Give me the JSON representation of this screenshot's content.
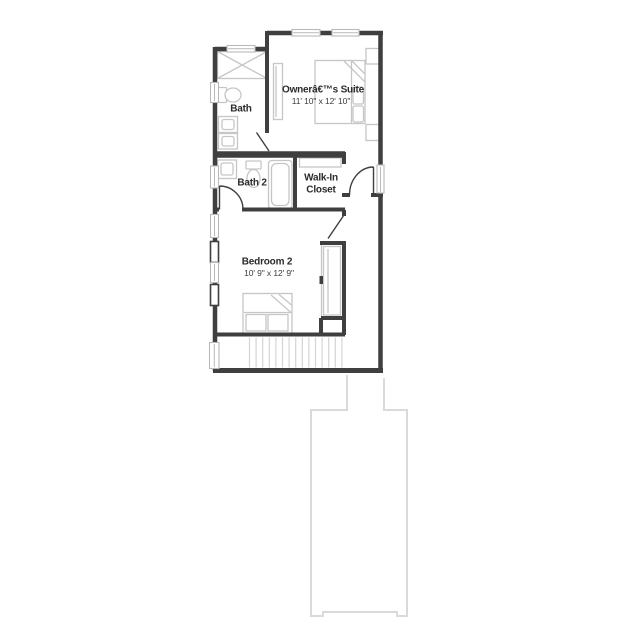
{
  "floor_plan": {
    "rooms": {
      "owner_suite": {
        "label": "Ownerâ€™s Suite",
        "dims": "11' 10\" x 12' 10\""
      },
      "bath": {
        "label": "Bath"
      },
      "bath2": {
        "label": "Bath 2"
      },
      "walk_in_closet": {
        "line1": "Walk-In",
        "line2": "Closet"
      },
      "bedroom2": {
        "label": "Bedroom 2",
        "dims": "10' 9\" x 12' 9\""
      }
    },
    "colors": {
      "wall": "#3f3f3f",
      "fixture": "#c6c6c6",
      "window_frame": "#b9b9b9",
      "stair_tread": "#d4d4d4",
      "lower_level_outline": "#dadada",
      "text": "#2b2b2b",
      "text_dim": "#3c3c3c",
      "background": "#ffffff"
    }
  }
}
